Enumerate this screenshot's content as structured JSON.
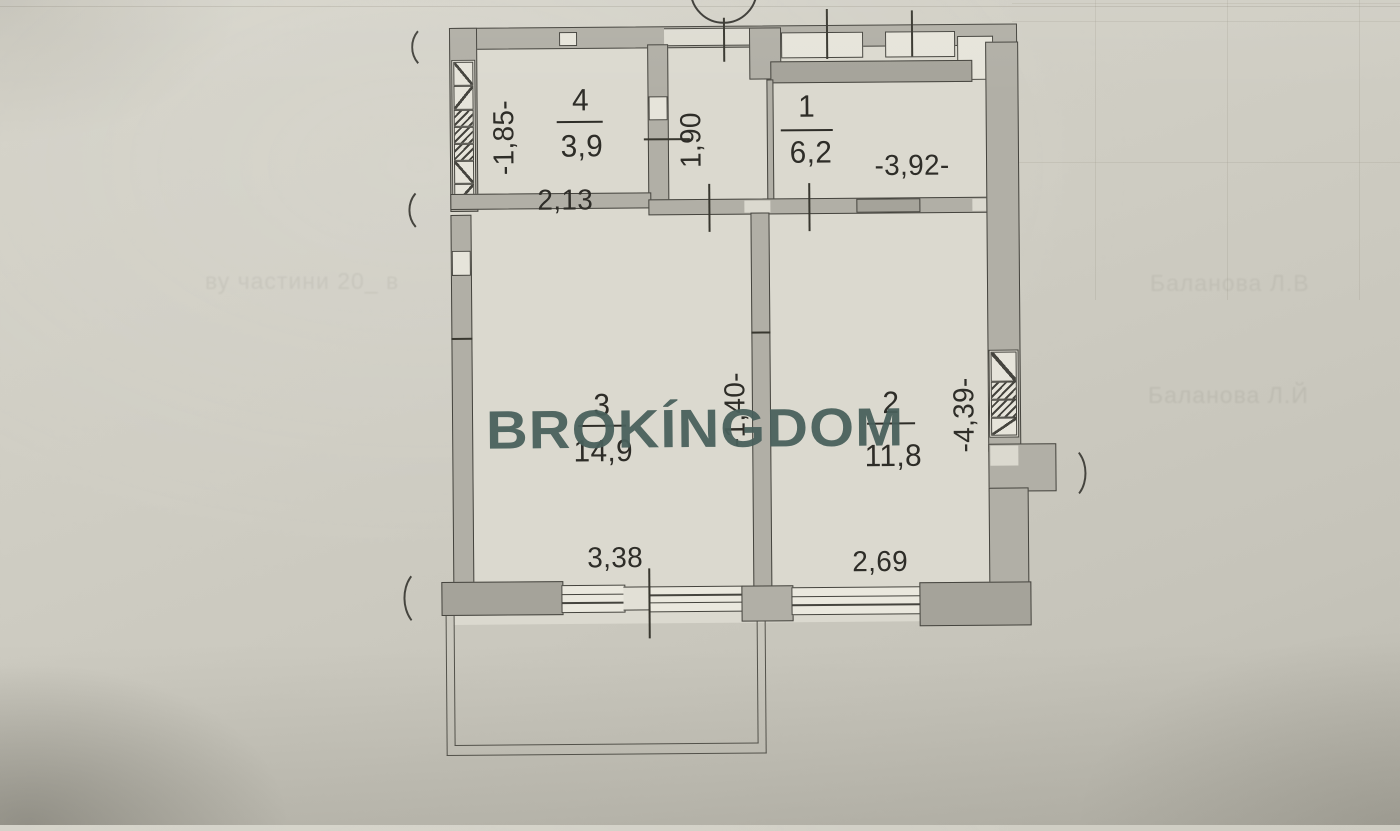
{
  "document": {
    "kind": "apartment floor plan photo",
    "watermark": {
      "text": "BROKÍNGDOM",
      "color": "#49605c"
    },
    "ink_color": "#2e2d28",
    "wall_color": "#b1afa6",
    "paper_color": "#cfcdc3"
  },
  "rooms": [
    {
      "key": "room-1",
      "number": "1",
      "area": "6,2"
    },
    {
      "key": "room-2",
      "number": "2",
      "area": "11,8"
    },
    {
      "key": "room-3",
      "number": "3",
      "area": "14,9"
    },
    {
      "key": "room-4",
      "number": "4",
      "area": "3,9"
    }
  ],
  "dimensions": {
    "room4_width": "2,13",
    "room4_depth": "-1,85-",
    "hall_width": "1,90",
    "room1_width": "-3,92-",
    "room3_width": "3,38",
    "room2_width": "2,69",
    "room2_depth": "-4,39-",
    "partition": "-1,40-"
  },
  "bleed_text": {
    "left": "ву частини 20_ в",
    "center": "Силав женовн",
    "right_top": "Баланова Л.В",
    "mid": "Рядчина Іванов",
    "right_mid": "Баланова Л.Й"
  }
}
